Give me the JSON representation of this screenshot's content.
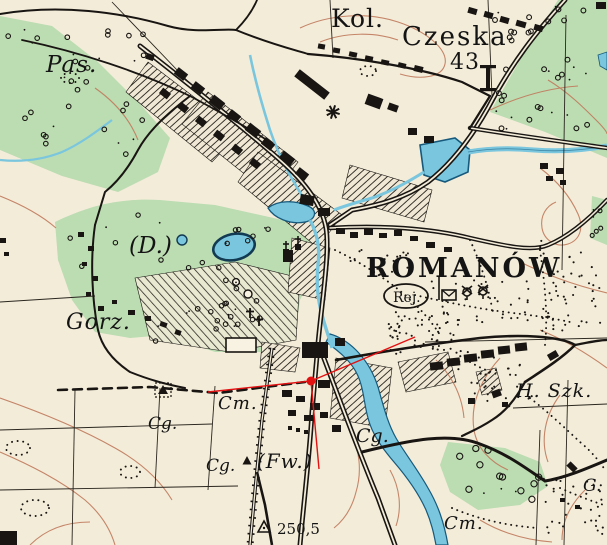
{
  "map": {
    "region_name": "ROMANÓW",
    "type": "historical-topographic-map",
    "colors": {
      "paper": "#f3ecd9",
      "vegetation": "#bcdcb2",
      "water_fill": "#79c6de",
      "water_stroke": "#16597c",
      "ink": "#181512",
      "contour": "#c07a5c",
      "annotation_red": "#e31111"
    },
    "labels": [
      {
        "id": "pas",
        "text": "Pas.",
        "x": 46,
        "y": 72,
        "size": 23,
        "style": "italic",
        "ls": 1
      },
      {
        "id": "kol",
        "text": "Kol.",
        "x": 331,
        "y": 27,
        "size": 25,
        "style": "serif",
        "ls": 1
      },
      {
        "id": "czeska",
        "text": "Czeska",
        "x": 402,
        "y": 45,
        "size": 26,
        "style": "serif",
        "ls": 2
      },
      {
        "id": "n43",
        "text": "43",
        "x": 450,
        "y": 69,
        "size": 22,
        "style": "serif",
        "ls": 1
      },
      {
        "id": "d",
        "text": "(D.)",
        "x": 129,
        "y": 253,
        "size": 23,
        "style": "italic",
        "ls": 0
      },
      {
        "id": "gorz",
        "text": "Gorz.",
        "x": 66,
        "y": 329,
        "size": 22,
        "style": "italic",
        "ls": 1
      },
      {
        "id": "romanow",
        "text": "ROMANÓW",
        "x": 366,
        "y": 277,
        "size": 27,
        "style": "boldcaps",
        "ls": 3
      },
      {
        "id": "rej",
        "text": "Rej.",
        "x": 393,
        "y": 302,
        "size": 14,
        "style": "serif",
        "ls": 0
      },
      {
        "id": "hszk",
        "text": "H. Szk.",
        "x": 516,
        "y": 397,
        "size": 19,
        "style": "italic",
        "ls": 1
      },
      {
        "id": "cm1",
        "text": "Cm.",
        "x": 218,
        "y": 409,
        "size": 18,
        "style": "italic",
        "ls": 1
      },
      {
        "id": "cg1",
        "text": "Cg.",
        "x": 148,
        "y": 429,
        "size": 17,
        "style": "italic",
        "ls": 0
      },
      {
        "id": "cg2",
        "text": "Cg.",
        "x": 206,
        "y": 471,
        "size": 17,
        "style": "italic",
        "ls": 0
      },
      {
        "id": "fw",
        "text": "(Fw.)",
        "x": 257,
        "y": 468,
        "size": 20,
        "style": "italic",
        "ls": 1
      },
      {
        "id": "cg3",
        "text": "Cg.",
        "x": 356,
        "y": 442,
        "size": 19,
        "style": "italic",
        "ls": 0
      },
      {
        "id": "cm2",
        "text": "Cm.",
        "x": 444,
        "y": 529,
        "size": 18,
        "style": "italic",
        "ls": 1
      },
      {
        "id": "g",
        "text": "G.",
        "x": 583,
        "y": 491,
        "size": 17,
        "style": "italic",
        "ls": 0
      },
      {
        "id": "h2505",
        "text": "250,5",
        "x": 277,
        "y": 534,
        "size": 15,
        "style": "serif",
        "ls": 0
      }
    ],
    "symbols": [
      {
        "type": "oval",
        "name": "rej-oval",
        "x": 406,
        "y": 296,
        "rx": 22,
        "ry": 12
      },
      {
        "type": "windmill-star",
        "name": "windmill-icon",
        "x": 333,
        "y": 112
      },
      {
        "type": "post",
        "name": "post-office-icon",
        "x": 448,
        "y": 295
      },
      {
        "type": "windmill",
        "name": "windmill-icon",
        "x": 467,
        "y": 292
      },
      {
        "type": "windmill",
        "name": "windmill-icon",
        "x": 483,
        "y": 291
      },
      {
        "type": "church",
        "name": "church-icon",
        "x": 286,
        "y": 252
      },
      {
        "type": "church",
        "name": "church-icon",
        "x": 298,
        "y": 247
      },
      {
        "type": "cross",
        "name": "cemetery-cross-icon",
        "x": 250,
        "y": 313
      },
      {
        "type": "cross",
        "name": "cemetery-cross-icon",
        "x": 259,
        "y": 321
      },
      {
        "type": "cemetery",
        "name": "cemetery-plot-icon",
        "x": 163,
        "y": 390
      },
      {
        "type": "solid-triangle",
        "name": "flag-icon",
        "x": 247,
        "y": 461
      },
      {
        "type": "trig-point",
        "name": "trig-point-icon",
        "x": 264,
        "y": 527
      },
      {
        "type": "gate",
        "name": "barrier-icon",
        "x": 488,
        "y": 78
      }
    ],
    "annotation": {
      "color": "#e31111",
      "dot": {
        "x": 311,
        "y": 381,
        "r": 4.5
      },
      "lines": [
        [
          311,
          381,
          415,
          337
        ],
        [
          311,
          381,
          208,
          392
        ],
        [
          311,
          381,
          319,
          469
        ]
      ]
    }
  }
}
